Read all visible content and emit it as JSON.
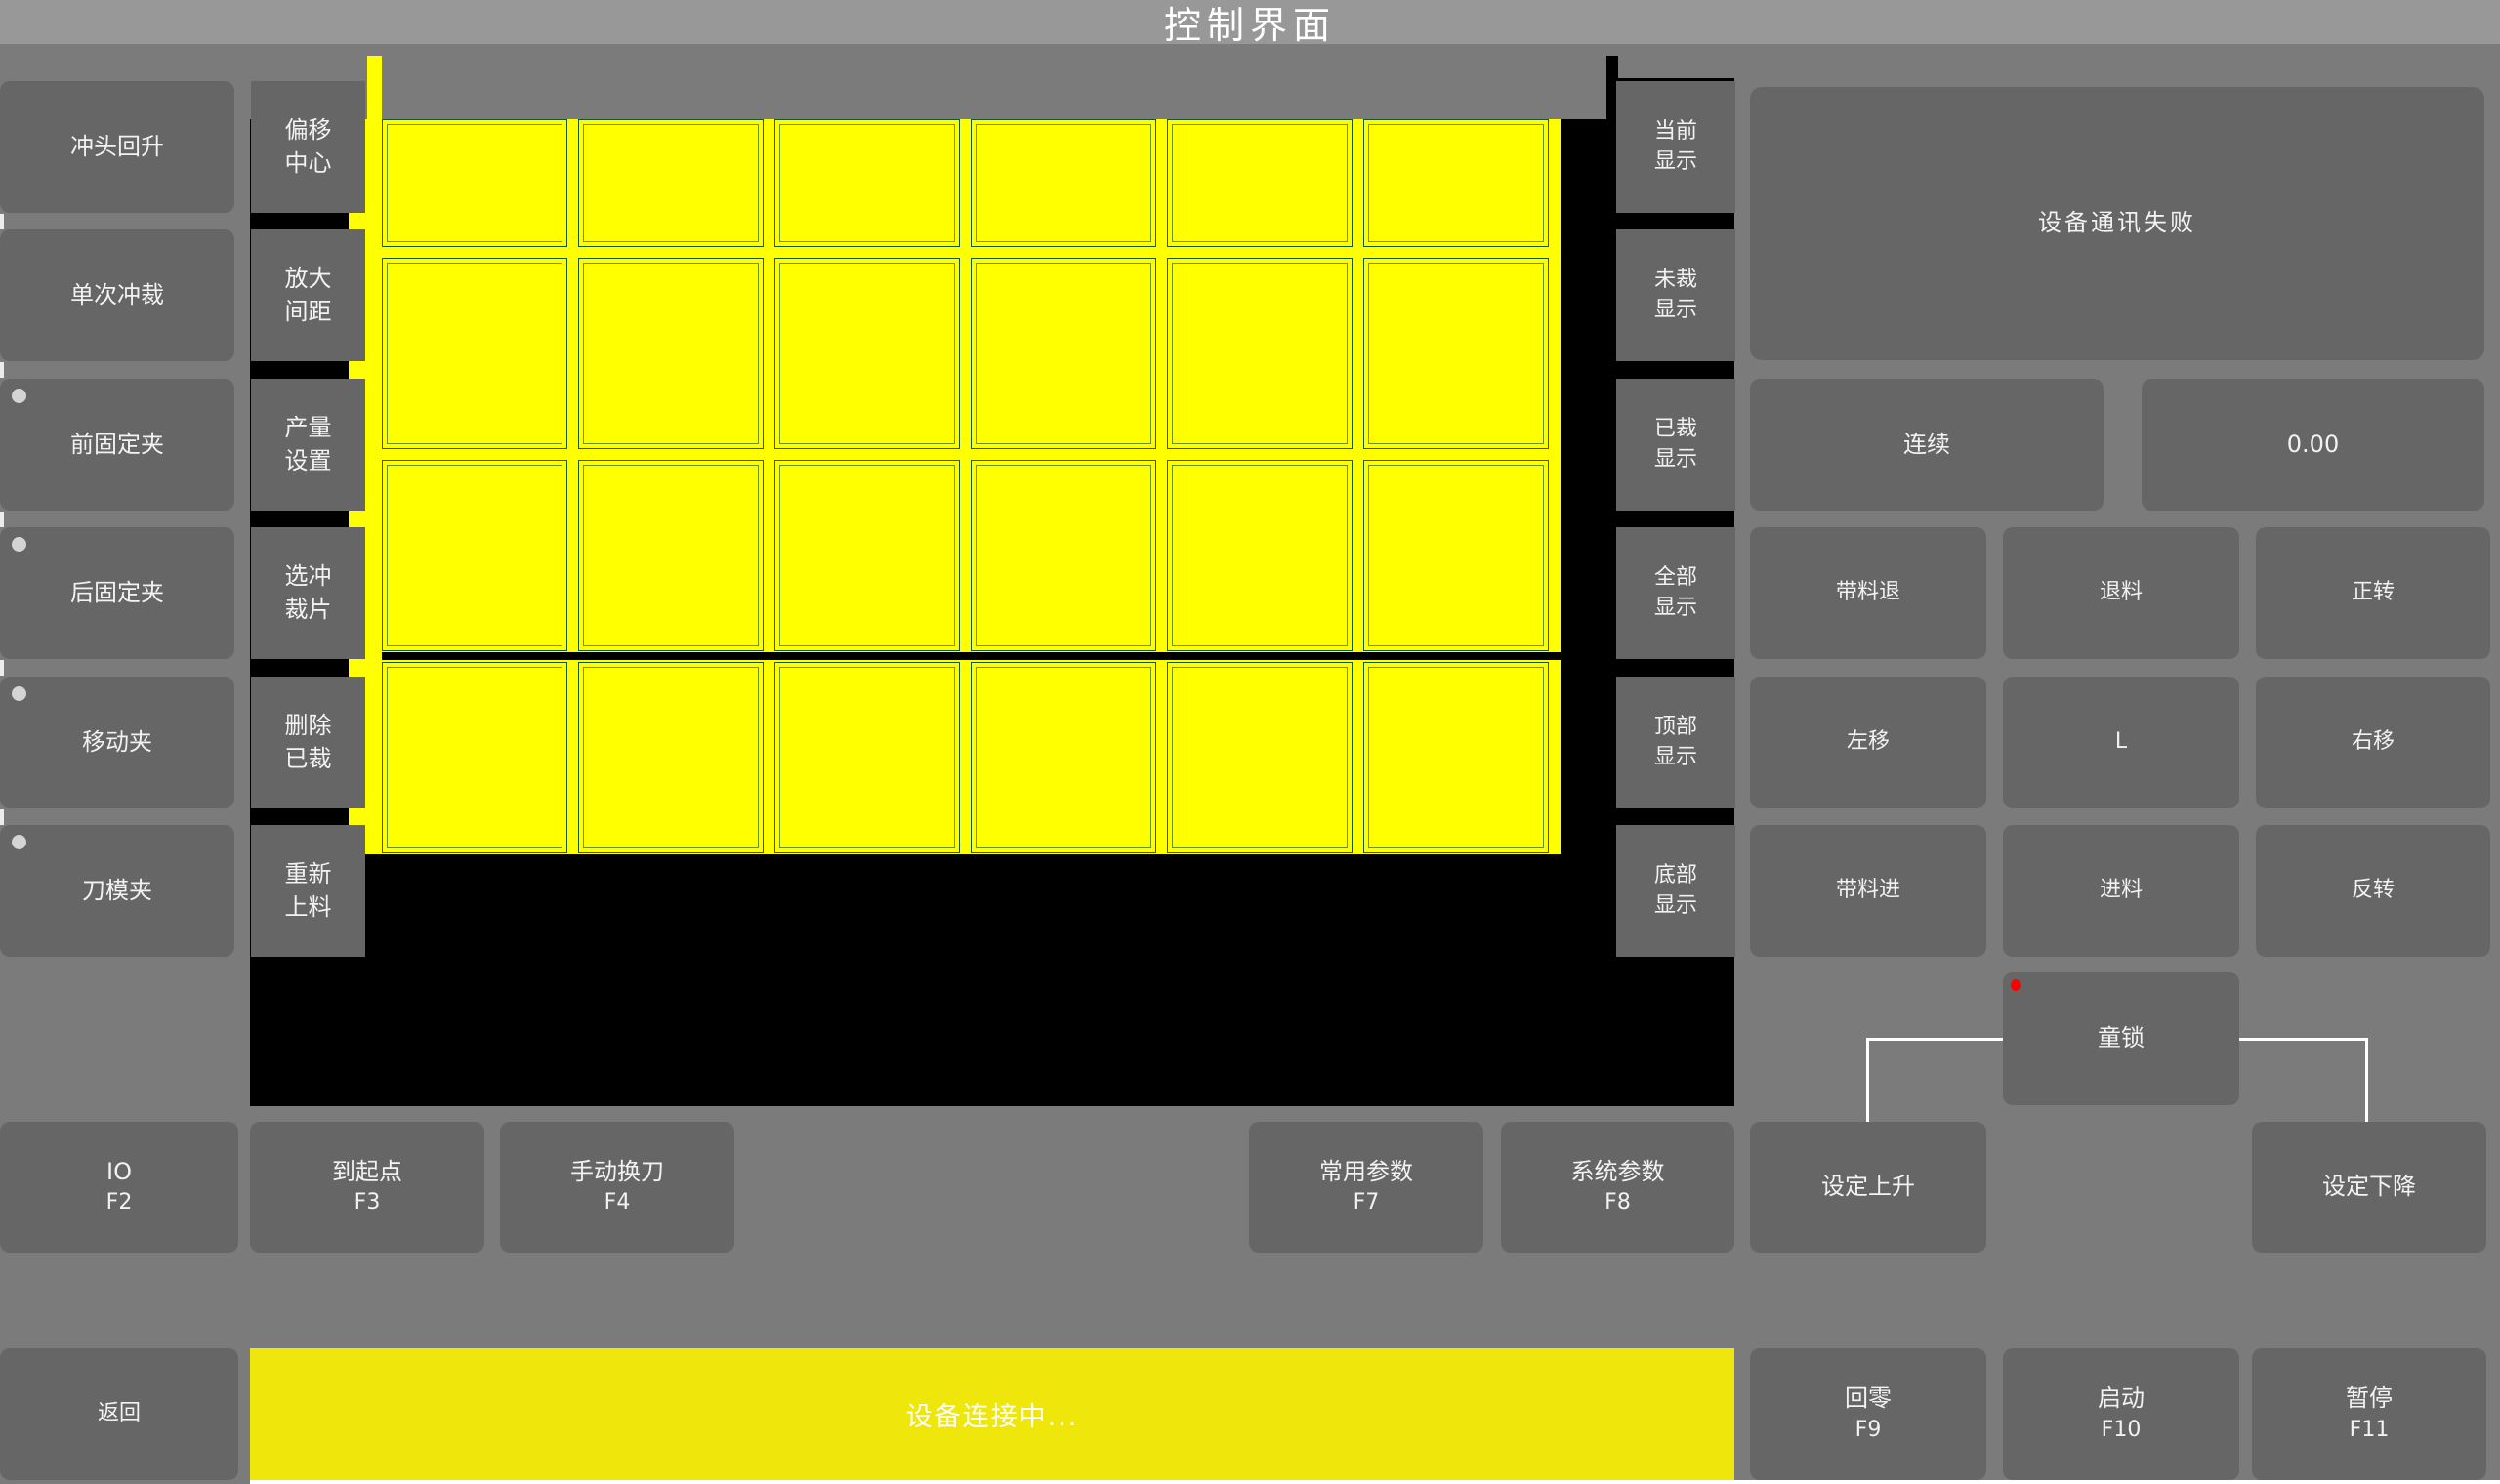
{
  "title": "控制界面",
  "left_buttons": [
    {
      "label": "冲头回升",
      "indicator": false
    },
    {
      "label": "单次冲裁",
      "indicator": false
    },
    {
      "label": "前固定夹",
      "indicator": true
    },
    {
      "label": "后固定夹",
      "indicator": true
    },
    {
      "label": "移动夹",
      "indicator": true
    },
    {
      "label": "刀模夹",
      "indicator": true
    }
  ],
  "tool_buttons": [
    {
      "line1": "偏移",
      "line2": "中心"
    },
    {
      "line1": "放大",
      "line2": "间距"
    },
    {
      "line1": "产量",
      "line2": "设置"
    },
    {
      "line1": "选冲",
      "line2": "裁片"
    },
    {
      "line1": "删除",
      "line2": "已裁"
    },
    {
      "line1": "重新",
      "line2": "上料"
    }
  ],
  "display_buttons": [
    {
      "line1": "当前",
      "line2": "显示"
    },
    {
      "line1": "未裁",
      "line2": "显示"
    },
    {
      "line1": "已裁",
      "line2": "显示"
    },
    {
      "line1": "全部",
      "line2": "显示"
    },
    {
      "line1": "顶部",
      "line2": "显示"
    },
    {
      "line1": "底部",
      "line2": "显示"
    }
  ],
  "panel": {
    "message": "设备通讯失败",
    "continuous_label": "连续",
    "value": "0.00",
    "grid_buttons": [
      "带料退",
      "退料",
      "正转",
      "左移",
      "L",
      "右移",
      "带料进",
      "进料",
      "反转"
    ],
    "child_lock_label": "童锁"
  },
  "function_buttons": [
    {
      "label": "IO",
      "key": "F2"
    },
    {
      "label": "到起点",
      "key": "F3"
    },
    {
      "label": "手动换刀",
      "key": "F4"
    },
    {
      "label": "常用参数",
      "key": "F7"
    },
    {
      "label": "系统参数",
      "key": "F8"
    },
    {
      "label": "设定上升",
      "key": ""
    },
    {
      "label": "设定下降",
      "key": ""
    }
  ],
  "bottom": {
    "back_label": "返回",
    "status_text": "设备连接中...",
    "buttons": [
      {
        "label": "回零",
        "key": "F9"
      },
      {
        "label": "启动",
        "key": "F10"
      },
      {
        "label": "暂停",
        "key": "F11"
      }
    ]
  },
  "canvas": {
    "columns": 6,
    "rows": 4,
    "pieces_state": "uncut"
  },
  "colors": {
    "background": "#7b7b7b",
    "titlebar": "#989898",
    "button_gray": "#666666",
    "canvas_black": "#000000",
    "piece_yellow": "#ffff00",
    "piece_outline": "#175a22",
    "status_yellow": "#efe70c",
    "alert_red": "#ff0000",
    "indicator_gray": "#d4d4d4",
    "line_white": "#ffffff"
  }
}
